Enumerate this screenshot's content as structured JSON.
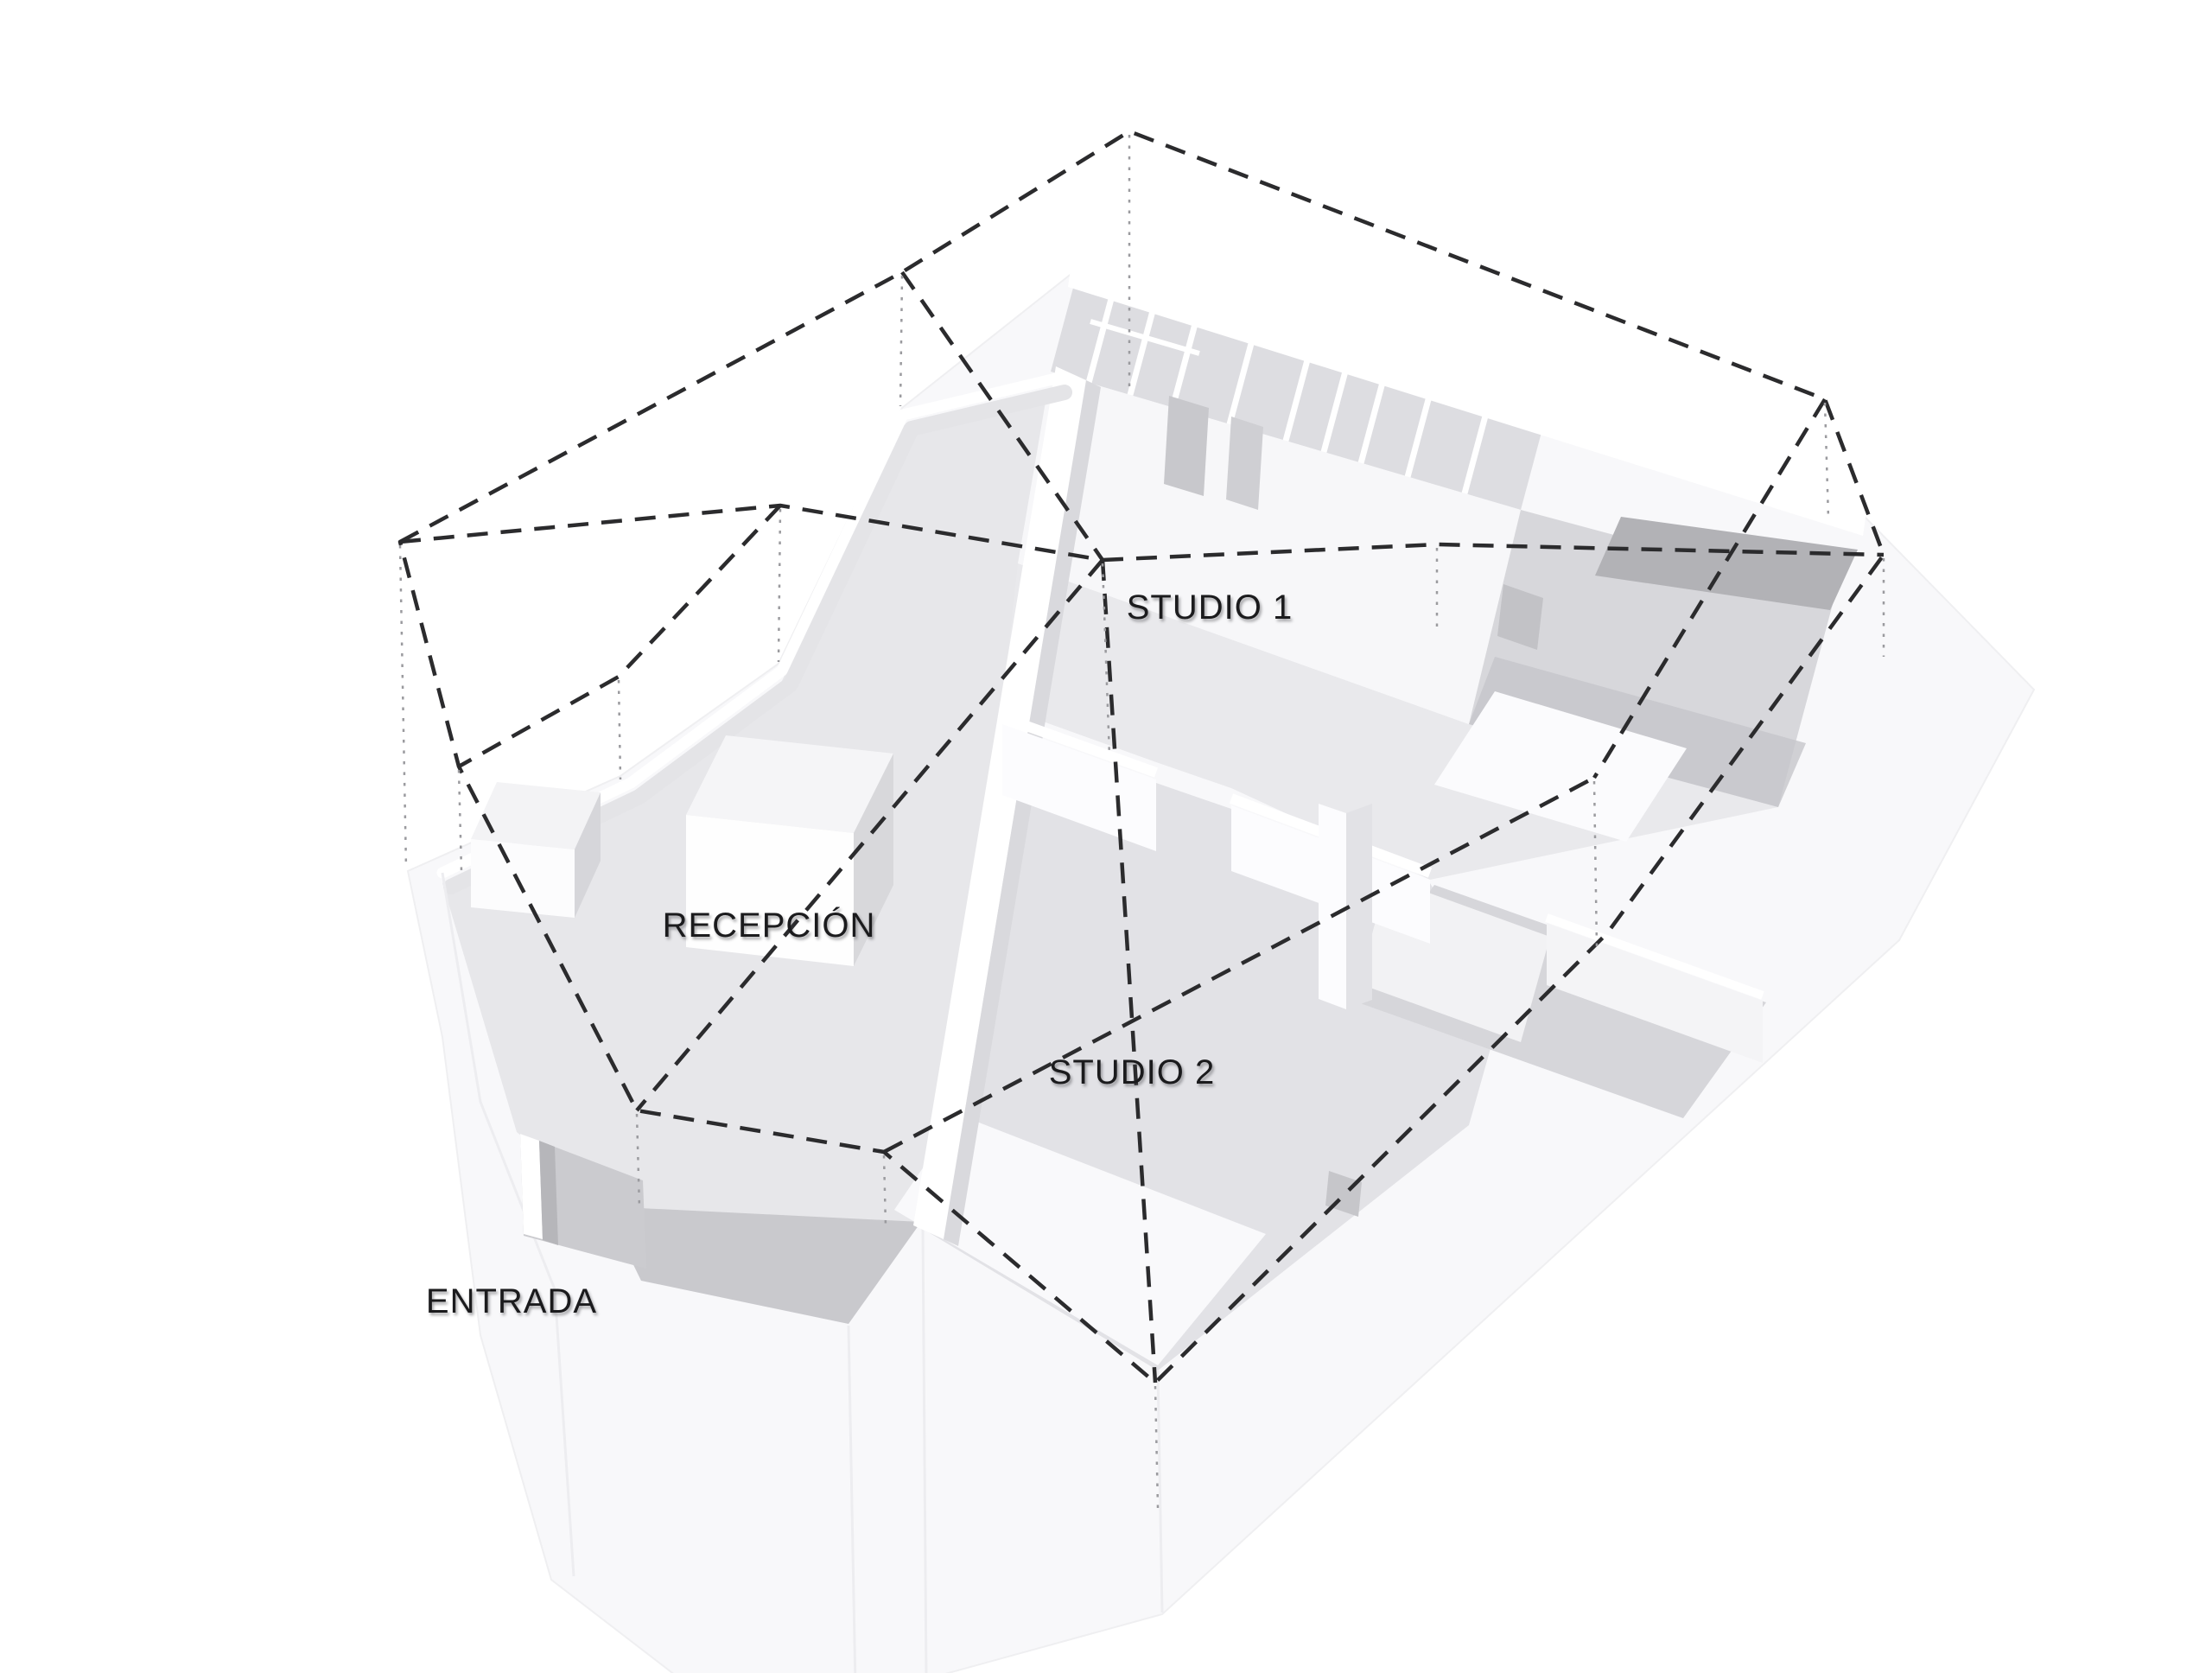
{
  "diagram": {
    "type": "axonometric-floor-plan-3d",
    "labels": {
      "studio1": "STUDIO 1",
      "studio2": "STUDIO 2",
      "reception": "RECEPCIÓN",
      "entrance": "ENTRADA"
    },
    "colors": {
      "background": "#ffffff",
      "shell": "#f8f8fa",
      "floor": "#e6e6e9",
      "floor_dark": "#b2b2b6",
      "wall_white": "#ffffff",
      "dash_line": "#2b2b2d",
      "dot_line": "#9b9b9f",
      "text": "#1b1b1d"
    }
  }
}
